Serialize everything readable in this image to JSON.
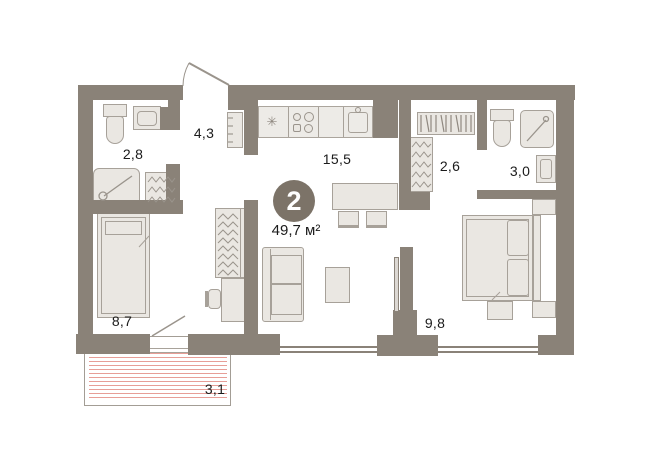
{
  "plan": {
    "badge": {
      "number": "2",
      "area_label": "49,7 м²"
    },
    "rooms": [
      {
        "name": "bathroom-top-left",
        "label": "2,8"
      },
      {
        "name": "hallway",
        "label": "4,3"
      },
      {
        "name": "kitchen-living-room",
        "label": "15,5"
      },
      {
        "name": "wardrobe",
        "label": "2,6"
      },
      {
        "name": "bathroom-right",
        "label": "3,0"
      },
      {
        "name": "bedroom-left",
        "label": "8,7"
      },
      {
        "name": "bedroom-right",
        "label": "9,8"
      },
      {
        "name": "balcony",
        "label": "3,1"
      }
    ],
    "icons": {
      "fridge": "✳"
    },
    "colors": {
      "wall": "#8a8278",
      "furniture_fill": "#eae7e2",
      "furniture_stroke": "#a7a199",
      "badge_bg": "#7c7368",
      "badge_text": "#ffffff",
      "balcony_hatch": "#e79e97",
      "text": "#1b1b1b"
    }
  }
}
